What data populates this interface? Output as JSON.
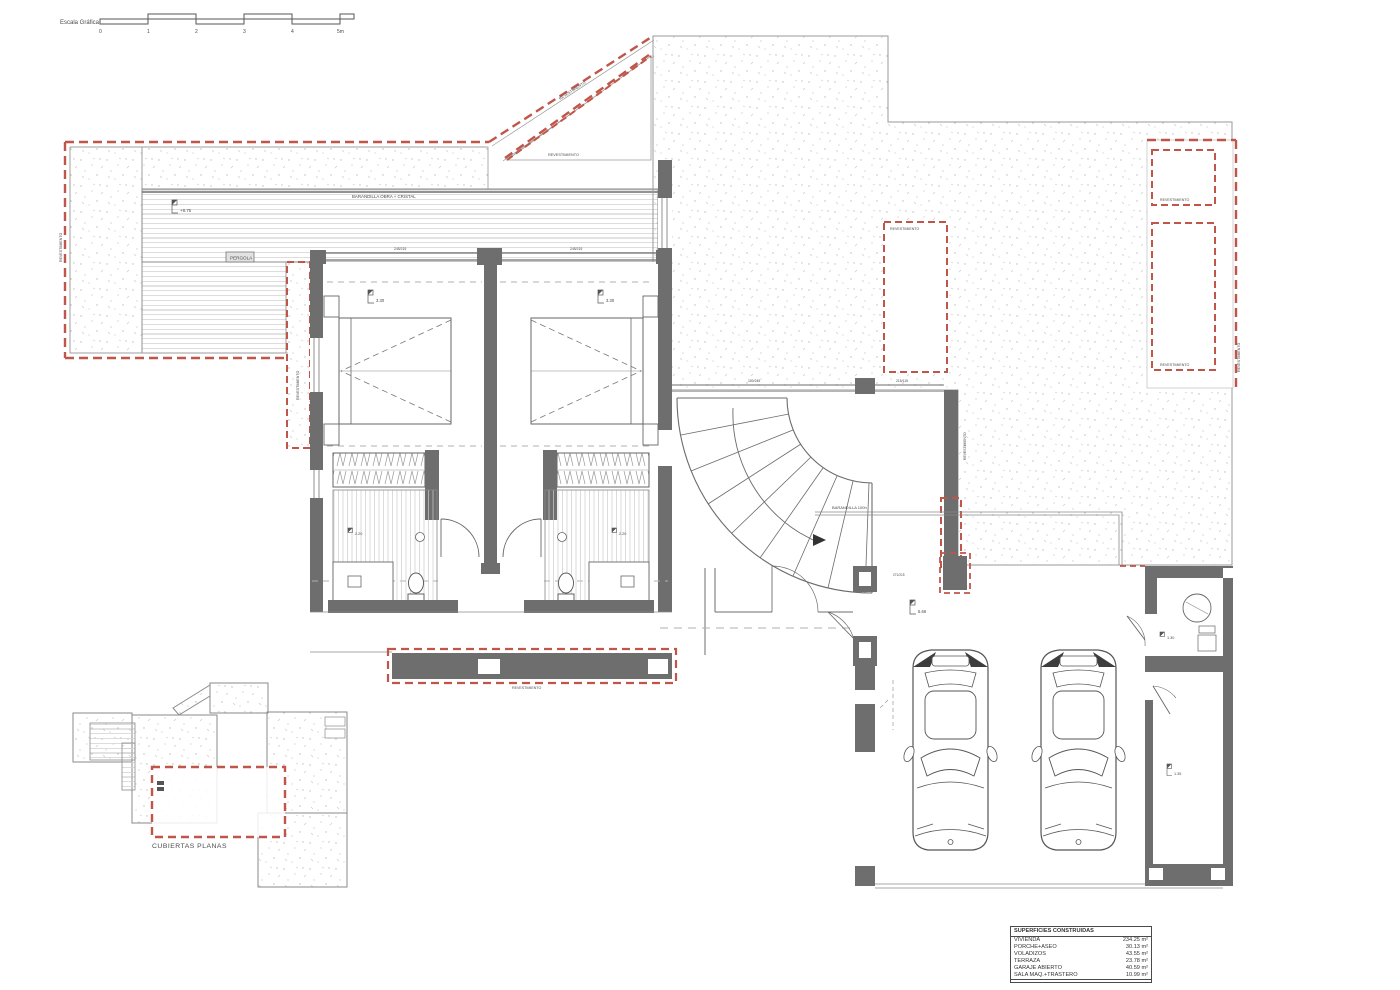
{
  "scale_bar": {
    "label": "Escala Gráfica",
    "ticks": [
      "0",
      "1",
      "2",
      "3",
      "4",
      "5m"
    ]
  },
  "labels": {
    "revestimiento": "REVESTIMIENTO",
    "barandilla_obra": "BARANDILLA OBRA + CRISTAL",
    "barandilla_stairs": "BARANDILLA 100h",
    "pergola": "PERGOLA",
    "cubiertas_planas": "CUBIERTAS PLANAS"
  },
  "levels": {
    "terrace": "+8.75",
    "bedroom_left": "3.30",
    "bedroom_right": "3.30",
    "bath_left": "2.20",
    "bath_right": "2.20",
    "garage": "5.66",
    "machine_room": "1.30",
    "storage": "1.35"
  },
  "dims": {
    "window_left": "245/215",
    "window_right": "245/215",
    "hall_top_1": "150/245",
    "hall_top_2": "215/115",
    "entry": "271/215"
  },
  "areas_table": {
    "title": "SUPERFICIES CONSTRUIDAS",
    "rows": [
      {
        "name": "VIVIENDA",
        "value": "234.25 m²"
      },
      {
        "name": "PORCHE+ASEO",
        "value": "30.13 m²"
      },
      {
        "name": "VOLADIZOS",
        "value": "43.55 m²"
      },
      {
        "name": "TERRAZA",
        "value": "23.78 m²"
      },
      {
        "name": "GARAJE ABIERTO",
        "value": "40.59 m²"
      },
      {
        "name": "SALA MAQ.+TRASTERO",
        "value": "10.99 m²"
      }
    ]
  },
  "colors": {
    "wall": "#6e6e6e",
    "red_dash": "#c0564a",
    "line": "#8a8a8a"
  }
}
